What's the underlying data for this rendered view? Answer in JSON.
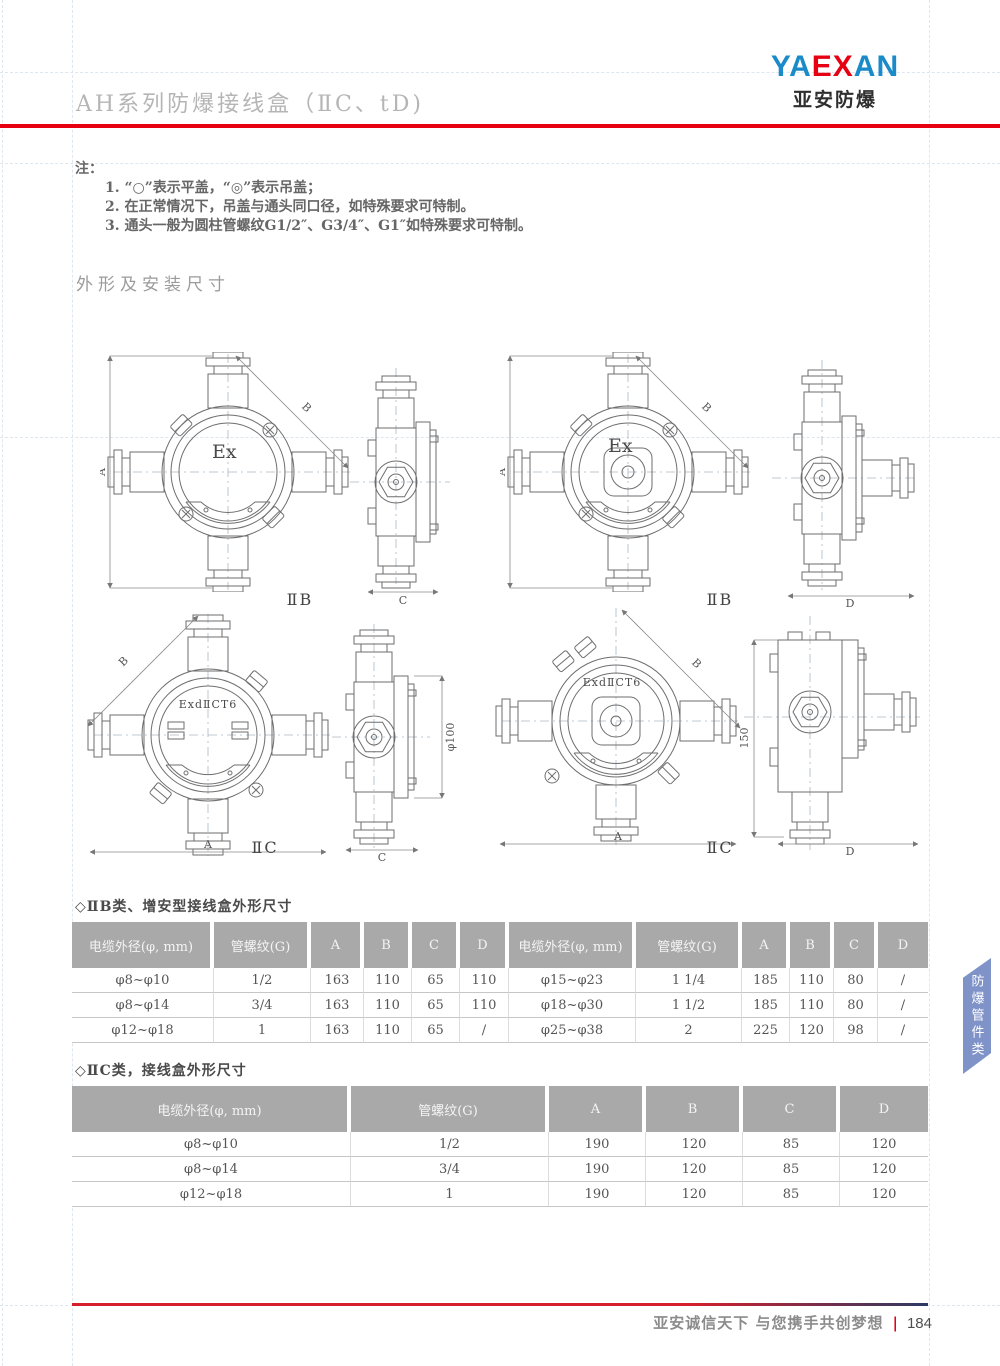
{
  "header": {
    "title": "AH系列防爆接线盒（ⅡC、tD)",
    "logo": {
      "segments": [
        {
          "text": "YA",
          "color": "#1a8ac9"
        },
        {
          "text": "EX",
          "color": "#e60012"
        },
        {
          "text": "AN",
          "color": "#1a8ac9"
        }
      ],
      "subtitle": "亚安防爆"
    },
    "rule_color": "#e60012"
  },
  "notes": {
    "label": "注：",
    "items": [
      "1. “○”表示平盖，“◎”表示吊盖；",
      "2. 在正常情况下，吊盖与通头同口径，如特殊要求可特制。",
      "3. 通头一般为圆柱管螺纹G1/2″、G3/4″、G1″如特殊要求可特制。"
    ]
  },
  "section_title": "外形及安装尺寸",
  "drawings": {
    "g1": {
      "mark": "Ex",
      "type_label": "ⅡB",
      "dim_left": "A",
      "dim_diag": "B",
      "dim_side_bottom": "C"
    },
    "g2": {
      "mark": "Ex",
      "type_label": "ⅡB",
      "dim_left": "A",
      "dim_diag": "B",
      "dim_side_bottom": "D"
    },
    "g3": {
      "mark": "ExdⅡCT6",
      "type_label": "ⅡC",
      "dim_bottom": "A",
      "dim_diag": "B",
      "dim_side_bottom": "C",
      "dim_side_right": "φ100"
    },
    "g4": {
      "mark": "ExdⅡCT6",
      "type_label": "ⅡC",
      "dim_bottom": "A",
      "dim_diag": "B",
      "dim_side_bottom": "D",
      "dim_side_left": "150"
    }
  },
  "tables": {
    "t1": {
      "title": "◇ⅡB类、增安型接线盒外形尺寸",
      "headers": [
        "电缆外径(φ, mm)",
        "管螺纹(G)",
        "A",
        "B",
        "C",
        "D",
        "电缆外径(φ, mm)",
        "管螺纹(G)",
        "A",
        "B",
        "C",
        "D"
      ],
      "rows": [
        [
          "φ8~φ10",
          "1/2",
          "163",
          "110",
          "65",
          "110",
          "φ15~φ23",
          "1 1/4",
          "185",
          "110",
          "80",
          "/"
        ],
        [
          "φ8~φ14",
          "3/4",
          "163",
          "110",
          "65",
          "110",
          "φ18~φ30",
          "1 1/2",
          "185",
          "110",
          "80",
          "/"
        ],
        [
          "φ12~φ18",
          "1",
          "163",
          "110",
          "65",
          "/",
          "φ25~φ38",
          "2",
          "225",
          "120",
          "98",
          "/"
        ]
      ]
    },
    "t2": {
      "title": "◇ⅡC类，接线盒外形尺寸",
      "headers": [
        "电缆外径(φ, mm)",
        "管螺纹(G)",
        "A",
        "B",
        "C",
        "D"
      ],
      "rows": [
        [
          "φ8~φ10",
          "1/2",
          "190",
          "120",
          "85",
          "120"
        ],
        [
          "φ8~φ14",
          "3/4",
          "190",
          "120",
          "85",
          "120"
        ],
        [
          "φ12~φ18",
          "1",
          "190",
          "120",
          "85",
          "120"
        ]
      ]
    }
  },
  "side_tab": {
    "label": "防爆管件类",
    "color": "#8093c8"
  },
  "footer": {
    "slogan": "亚安诚信天下 与您携手共创梦想",
    "separator": "|",
    "page_number": "184"
  }
}
